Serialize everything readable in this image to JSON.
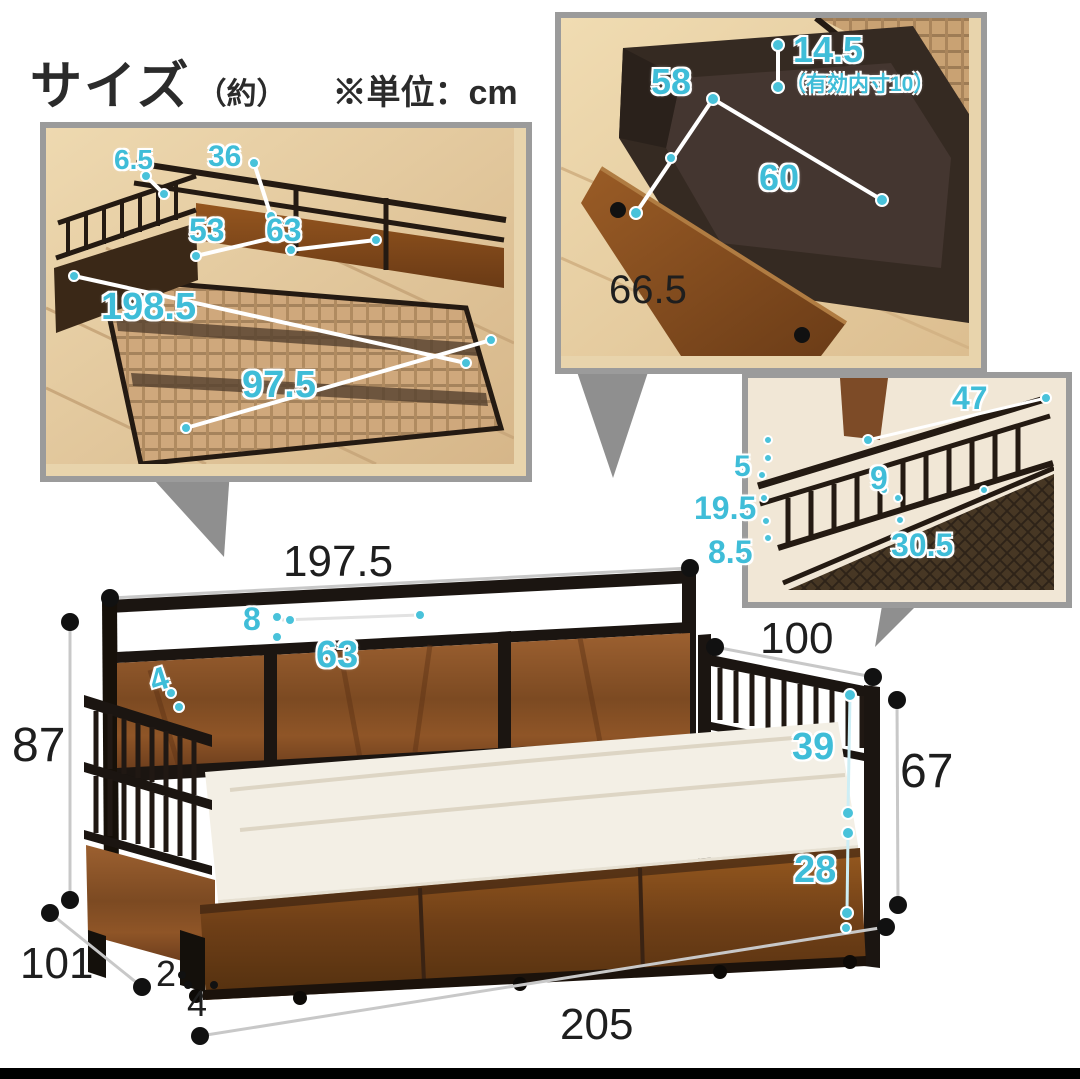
{
  "title": {
    "size_label": "サイズ",
    "approx": "（約）",
    "unit_note": "※単位：cm"
  },
  "colors": {
    "accent_cyan": "#3fbdd8",
    "text_black": "#1e1e1e",
    "inset_border": "#9b9b9b",
    "arrow_gray": "#8f8f8f",
    "wood_brown": "#8a5128",
    "frame_black": "#1b1511",
    "mattress_white": "#f3efe5"
  },
  "insets": {
    "frame": {
      "caption": "bed frame inner dimensions (top view)",
      "labels": [
        {
          "text": "6.5",
          "cls": "c",
          "x": 68,
          "y": 18,
          "size": 28
        },
        {
          "text": "36",
          "cls": "c",
          "x": 162,
          "y": 14,
          "size": 30
        },
        {
          "text": "53",
          "cls": "c",
          "x": 143,
          "y": 86,
          "size": 32
        },
        {
          "text": "63",
          "cls": "c",
          "x": 220,
          "y": 86,
          "size": 32
        },
        {
          "text": "198.5",
          "cls": "c",
          "x": 55,
          "y": 160,
          "size": 38
        },
        {
          "text": "97.5",
          "cls": "c",
          "x": 196,
          "y": 238,
          "size": 38
        }
      ]
    },
    "drawer": {
      "caption": "storage drawer dimensions",
      "labels": [
        {
          "text": "58",
          "cls": "c",
          "x": 90,
          "y": 46,
          "size": 36
        },
        {
          "text": "14.5",
          "cls": "c",
          "x": 232,
          "y": 14,
          "size": 36
        },
        {
          "text": "（有効内寸10）",
          "cls": "c",
          "x": 224,
          "y": 56,
          "size": 21
        },
        {
          "text": "60",
          "cls": "c",
          "x": 198,
          "y": 142,
          "size": 36
        },
        {
          "text": "66.5",
          "cls": "k",
          "x": 48,
          "y": 252,
          "size": 40
        }
      ]
    },
    "rail": {
      "caption": "side rail detail dimensions",
      "labels": [
        {
          "text": "47",
          "cls": "c",
          "x": 204,
          "y": 4,
          "size": 32
        },
        {
          "text": "5",
          "cls": "c",
          "x": -14,
          "y": 74,
          "size": 30
        },
        {
          "text": "9",
          "cls": "c",
          "x": 122,
          "y": 84,
          "size": 32
        },
        {
          "text": "19.5",
          "cls": "c",
          "x": -54,
          "y": 114,
          "size": 32
        },
        {
          "text": "8.5",
          "cls": "c",
          "x": -40,
          "y": 158,
          "size": 32
        },
        {
          "text": "30.5",
          "cls": "c",
          "x": 143,
          "y": 151,
          "size": 32
        }
      ]
    }
  },
  "main": {
    "caption": "daybed overall dimensions",
    "labels": [
      {
        "text": "197.5",
        "cls": "k",
        "x": 283,
        "y": 540,
        "size": 44
      },
      {
        "text": "8",
        "cls": "c",
        "x": 243,
        "y": 603,
        "size": 32
      },
      {
        "text": "63",
        "cls": "c",
        "x": 316,
        "y": 636,
        "size": 38
      },
      {
        "text": "4",
        "cls": "c",
        "x": 150,
        "y": 663,
        "size": 32,
        "rot": -18
      },
      {
        "text": "87",
        "cls": "k",
        "x": 12,
        "y": 722,
        "size": 48
      },
      {
        "text": "100",
        "cls": "k",
        "x": 760,
        "y": 617,
        "size": 44
      },
      {
        "text": "39",
        "cls": "c",
        "x": 792,
        "y": 728,
        "size": 38
      },
      {
        "text": "67",
        "cls": "k",
        "x": 900,
        "y": 748,
        "size": 48
      },
      {
        "text": "28",
        "cls": "c",
        "x": 794,
        "y": 851,
        "size": 38
      },
      {
        "text": "101",
        "cls": "k",
        "x": 20,
        "y": 942,
        "size": 44
      },
      {
        "text": "2",
        "cls": "k",
        "x": 156,
        "y": 956,
        "size": 36
      },
      {
        "text": "4",
        "cls": "k",
        "x": 187,
        "y": 986,
        "size": 36
      },
      {
        "text": "205",
        "cls": "k",
        "x": 560,
        "y": 1003,
        "size": 44
      }
    ]
  }
}
